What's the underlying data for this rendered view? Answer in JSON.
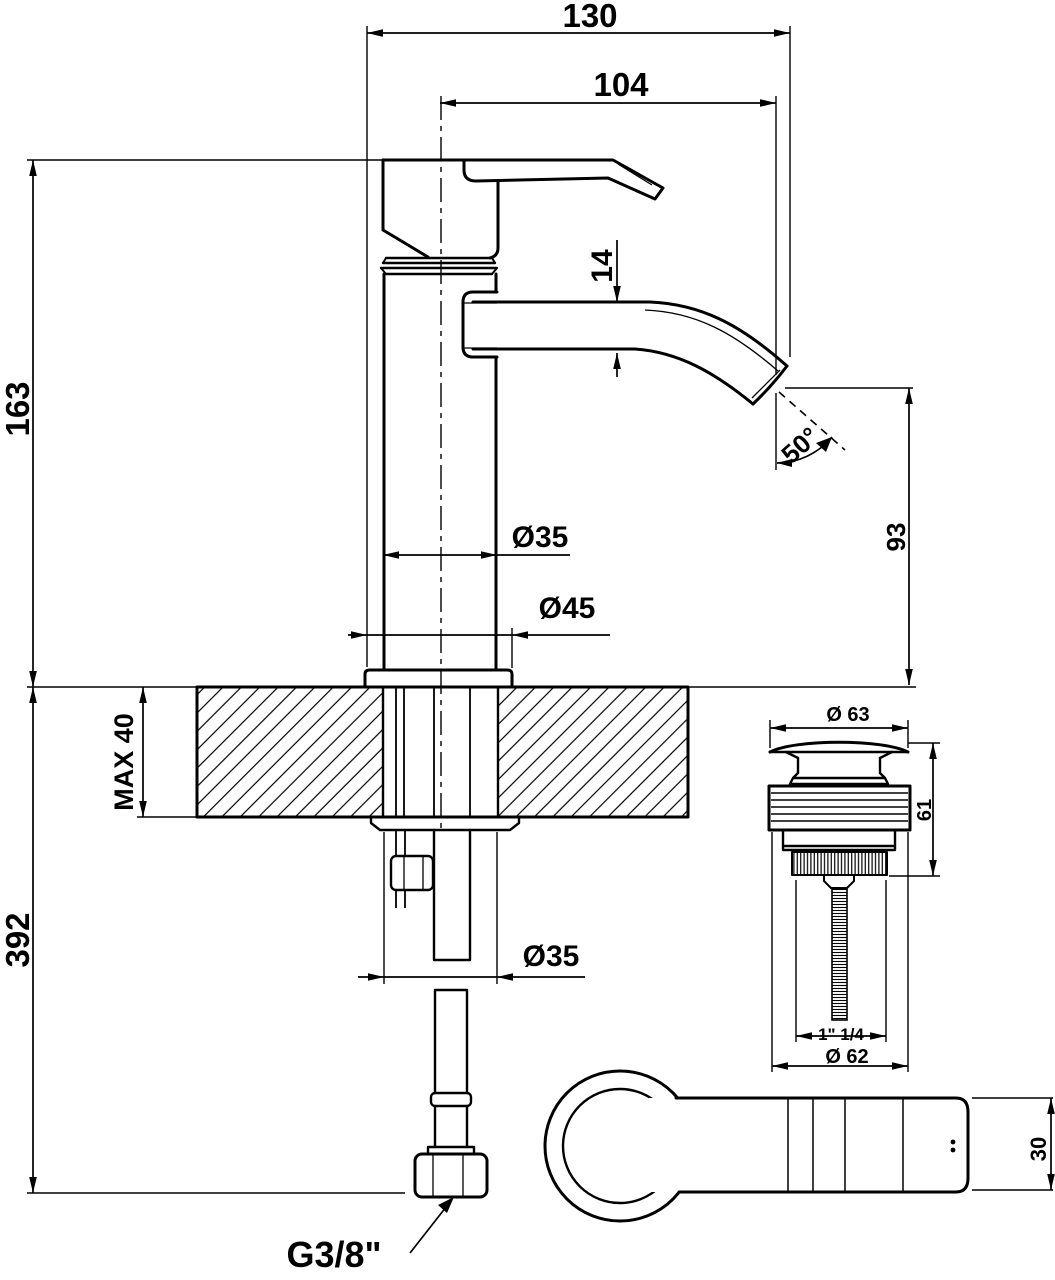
{
  "drawing": {
    "title": "Single-lever basin mixer - dimensional technical drawing",
    "colors": {
      "line": "#000000",
      "background": "#ffffff"
    },
    "front_view": {
      "overall_width": "130",
      "spout_projection": "104",
      "height_above_deck": "163",
      "height_below_outlet": "392",
      "deck_thickness": "MAX 40",
      "spout_tube_height": "14",
      "spout_angle": "50°",
      "outlet_height": "93",
      "body_diameter": "Ø35",
      "base_diameter": "Ø45",
      "shank_diameter": "Ø35",
      "supply_thread": "G3/8\""
    },
    "waste_view": {
      "cap_diameter": "Ø 63",
      "height": "61",
      "thread_size": "1\" 1/4",
      "flange_diameter": "Ø 62"
    },
    "top_view": {
      "handle_width": "30"
    }
  }
}
